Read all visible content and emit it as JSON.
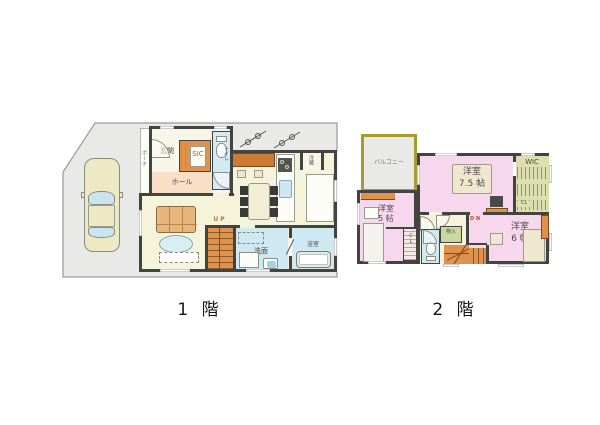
{
  "title": {
    "floor1": "1 階",
    "floor2": "2 階"
  },
  "floor1": {
    "porch": "ポーチ",
    "entrance": "玄関",
    "sic": "SIC",
    "toilet": "トイレ",
    "hall": "ホール",
    "fridge": "冷蔵",
    "ldk_name": "L・D・K",
    "ldk_size": "18.63 帖",
    "stairs_up": "U P",
    "washroom": "洗面",
    "bathroom": "浴室"
  },
  "floor2": {
    "balcony": "バルコニー",
    "bedroom_main": {
      "name": "洋室",
      "size": "7.5 帖"
    },
    "wic": "WIC",
    "wic_cl": "CL",
    "bedroom_left": {
      "name": "洋室",
      "size": "5 帖"
    },
    "closet": "CL",
    "storage": "物入",
    "stairs_down": "D N",
    "bedroom_right": {
      "name": "洋室",
      "size": "6 帖"
    }
  },
  "colors": {
    "wall": "#43433f",
    "floor_cream": "#F6F3DB",
    "plot_gray": "#E9E9E7",
    "stairs_orange": "#E0914C",
    "hall_peach": "#F9DFC5",
    "wet_blue": "#CFE9F2",
    "bedroom_pink": "#F6D7ED",
    "closet_green": "#DCE0B0",
    "balcony_olive": "#A89B2F",
    "sofa_tan": "#E9B57E"
  }
}
